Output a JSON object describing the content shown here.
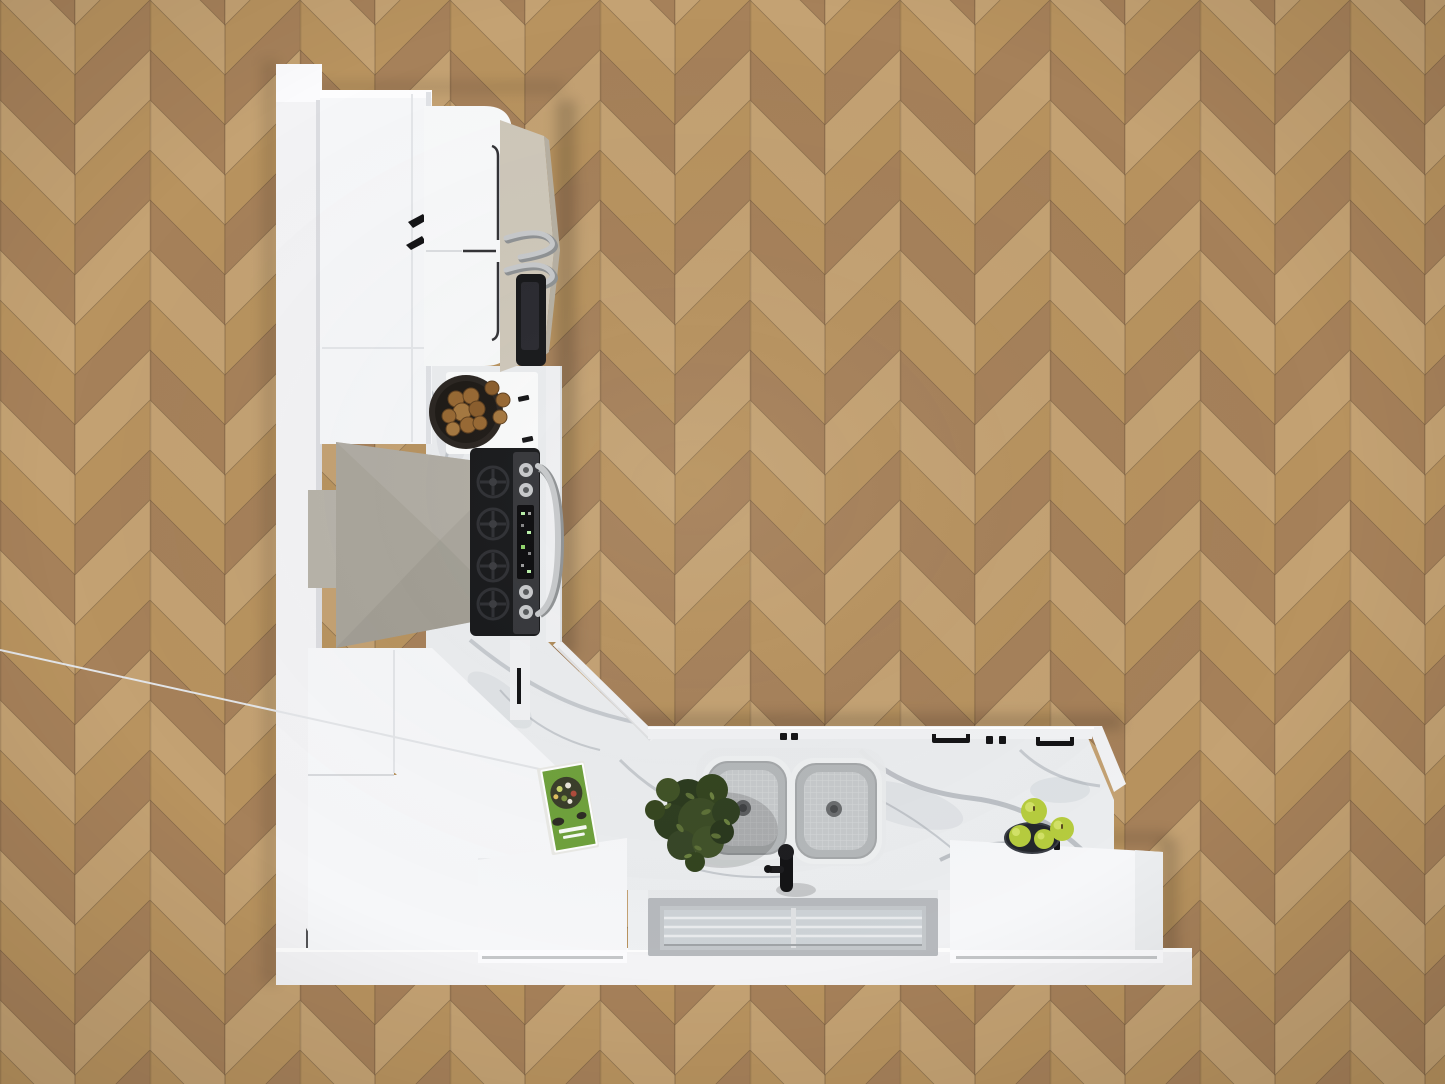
{
  "scene": {
    "description": "Top-down 3D render of an L-shaped white kitchen on a herringbone oak floor",
    "view": "overhead floor-plan render",
    "room": {
      "floor": "herringbone oak parquet",
      "walls": "white"
    }
  },
  "colors": {
    "wood_a": "#b8935f",
    "wood_b": "#a6815a",
    "wood_c": "#c4a273",
    "wood_seam": "#6d5438",
    "wall": "#f3f3f5",
    "wall_bright": "#fbfbfd",
    "cabinet_white": "#f6f7f9",
    "cabinet_front": "#fbfbfd",
    "cabinet_edge": "#e0e2e6",
    "marble_base": "#ebedef",
    "marble_vein": "#98a0a8",
    "marble_vein_dark": "#848c95",
    "hood_grey": "#a9a59b",
    "hood_grey_light": "#b7b3a9",
    "hood_grey_dark": "#9b978d",
    "fridge_door_beige": "#cfc8ba",
    "fridge_door_edge": "#b7b0a2",
    "appliance_black": "#17181a",
    "display_black": "#0b0b0d",
    "stainless": "#c7c9cb",
    "stainless_dark": "#8f9294",
    "window_frame": "#b6b9bd",
    "window_glass": "#cdd2d6",
    "window_bar": "#e9ebed",
    "sink_basin": "#b4b7b9",
    "sink_basin_light": "#c6c9cb",
    "sink_rim": "#eef0f1",
    "drain_grey": "#6a6d6f",
    "handle_black": "#141416",
    "plant_green": "#3c4c26",
    "plant_green_dark": "#2b3a1e",
    "plant_green_light": "#5d7038",
    "apple_green": "#b6cc3e",
    "apple_highlight": "#d7e56e",
    "nut_brown": "#976832",
    "bowl_dark": "#2a2520",
    "fruitbowl_dark": "#23262b",
    "book_green": "#6fa13c",
    "book_pages": "#e9e9e5",
    "shadow": "#000000"
  },
  "objects": {
    "floor": {
      "label": "herringbone oak parquet floor"
    },
    "left_wall": {
      "label": "left wall"
    },
    "bottom_wall": {
      "label": "bottom wall"
    },
    "pantry_cabinet": {
      "label": "tall white pantry cabinet with two black handles"
    },
    "refrigerator": {
      "label": "built-in refrigerator, white top, beige doors, steel handles, black water dispenser"
    },
    "counter_left": {
      "label": "marble countertop with white board"
    },
    "nut_bowl": {
      "label": "dark bowl of walnuts"
    },
    "range_hood": {
      "label": "greige pyramid range hood with duct box"
    },
    "range": {
      "label": "gas range, black grates, steel control panel with knobs and display, curved door handle"
    },
    "corner_cabinets": {
      "label": "white corner wall cabinets"
    },
    "corner_door": {
      "label": "corner cabinet door with black bar handle"
    },
    "sink_counter": {
      "label": "marble sink run countertop"
    },
    "sink": {
      "label": "stainless double-basin sink"
    },
    "faucet": {
      "label": "black kitchen faucet"
    },
    "window": {
      "label": "window behind the sink"
    },
    "left_island_box": {
      "label": "white protruding base cabinet (left of window)"
    },
    "right_island_box": {
      "label": "white protruding base cabinet (right of window)"
    },
    "plant": {
      "label": "leafy green houseplant"
    },
    "cookbook": {
      "label": "green salad cookbook lying on counter"
    },
    "apples": {
      "label": "green apples with small dark bowl"
    },
    "cabinet_handles": {
      "label": "black bar handles and knobs on cabinet fronts"
    }
  }
}
